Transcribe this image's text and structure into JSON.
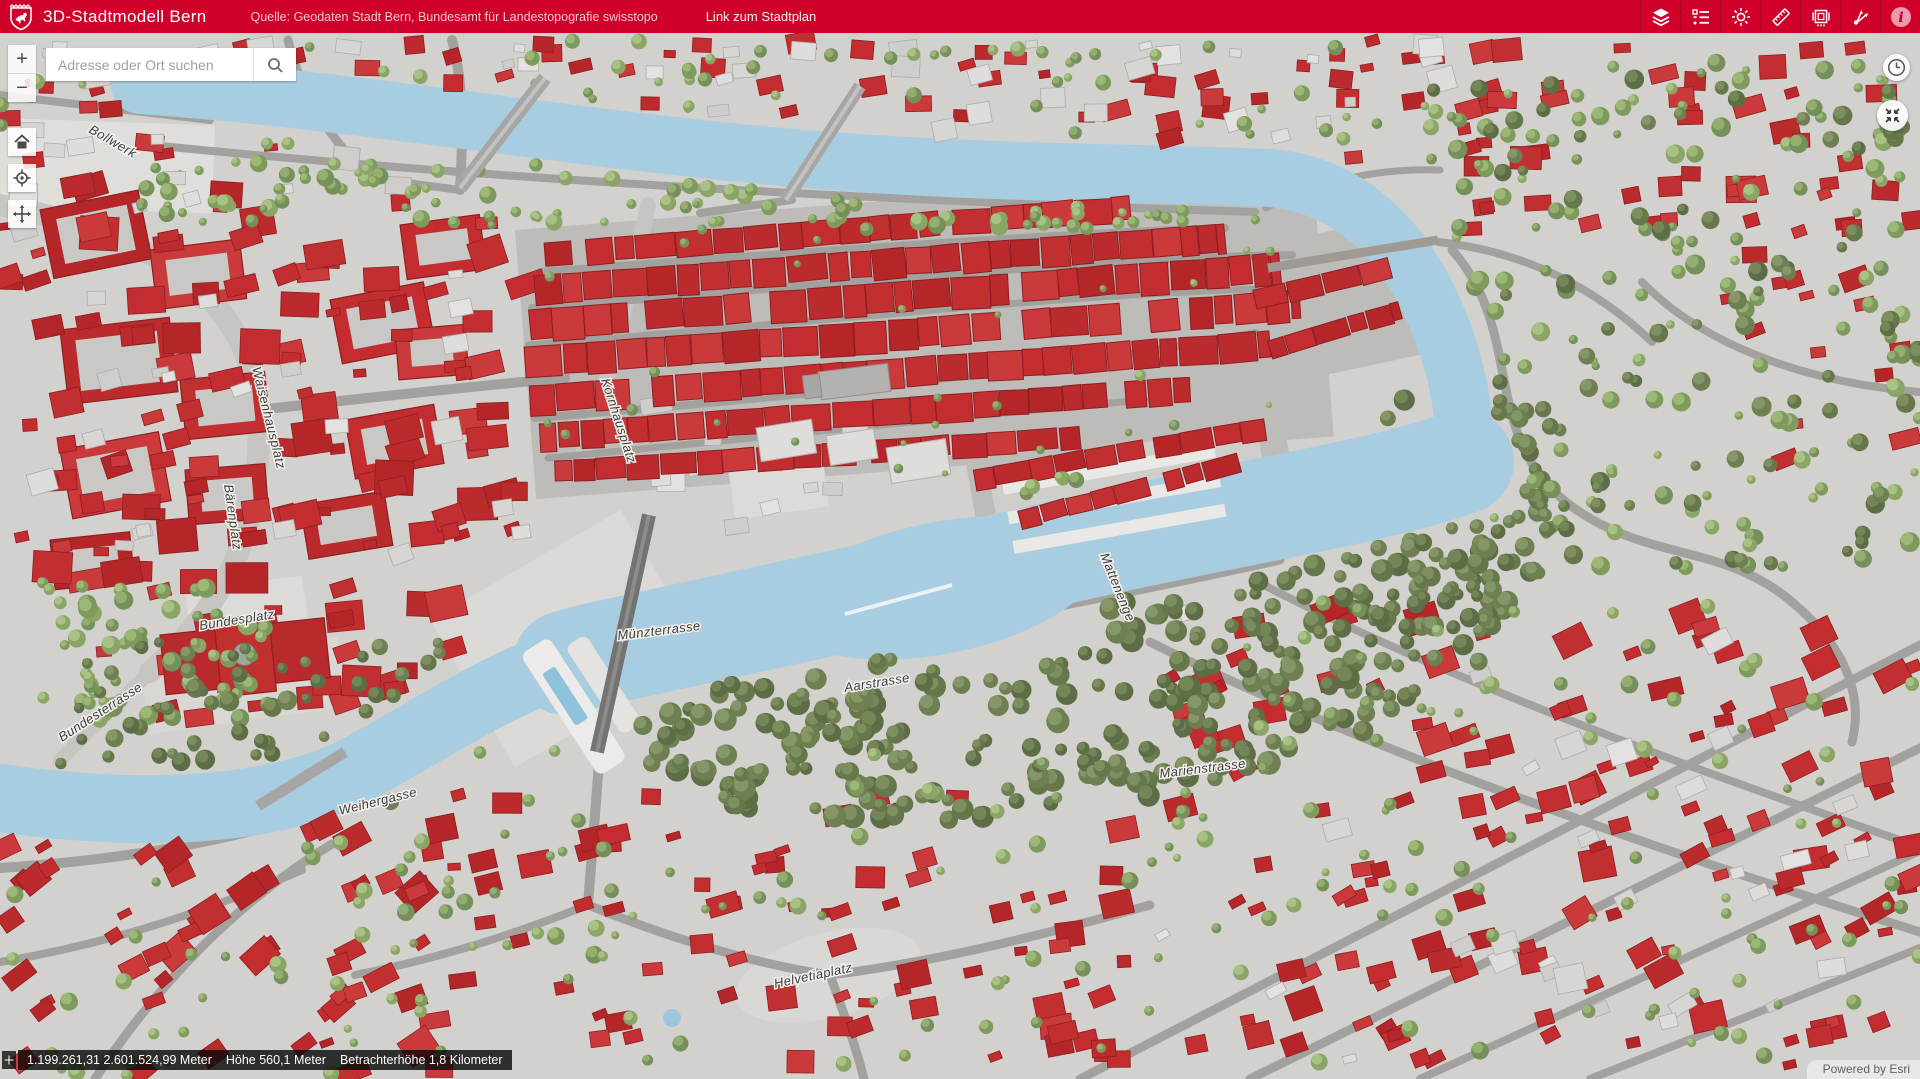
{
  "app": {
    "title": "3D-Stadtmodell Bern",
    "source_text": "Quelle: Geodaten Stadt Bern, Bundesamt für Landestopografie swisstopo",
    "stadtplan_link_label": "Link zum Stadtplan",
    "header_color": "#d0002b",
    "tools": [
      "layers",
      "legend",
      "daylight",
      "measure",
      "slides",
      "share",
      "info"
    ]
  },
  "search": {
    "placeholder": "Adresse oder Ort suchen"
  },
  "controls": {
    "zoom_in": "+",
    "zoom_out": "−"
  },
  "statusbar": {
    "coordinates": "1.199.261,31 2.601.524,99 Meter",
    "height_label": "Höhe 560,1 Meter",
    "viewer_height_label": "Betrachterhöhe 1,8 Kilometer"
  },
  "attribution": {
    "powered_by": "Powered by Esri"
  },
  "map": {
    "colors": {
      "river": "#a9cde0",
      "ground": "#d2d1ce",
      "road": "#a2a19e",
      "roof": "#c22f31",
      "roof_dark": "#8e1f22",
      "tree_light": "#9cb877",
      "tree_dark": "#7d8f5f"
    },
    "street_labels": [
      {
        "text": "Bollwerk",
        "x": 88,
        "y": 132,
        "rot": 30
      },
      {
        "text": "Waisenhausplatz",
        "x": 252,
        "y": 368,
        "rot": 76
      },
      {
        "text": "Kornhausplatz",
        "x": 601,
        "y": 380,
        "rot": 72
      },
      {
        "text": "Bärenplatz",
        "x": 224,
        "y": 485,
        "rot": 82
      },
      {
        "text": "Bundesplatz",
        "x": 200,
        "y": 630,
        "rot": -9
      },
      {
        "text": "Münzterrasse",
        "x": 618,
        "y": 640,
        "rot": -7
      },
      {
        "text": "Mattenenge",
        "x": 1100,
        "y": 555,
        "rot": 68
      },
      {
        "text": "Aarstrasse",
        "x": 845,
        "y": 692,
        "rot": -9
      },
      {
        "text": "Bundesterrasse",
        "x": 62,
        "y": 742,
        "rot": -33
      },
      {
        "text": "Weihergasse",
        "x": 340,
        "y": 815,
        "rot": -14
      },
      {
        "text": "Marienstrasse",
        "x": 1160,
        "y": 778,
        "rot": -7
      },
      {
        "text": "Helvetiaplatz",
        "x": 775,
        "y": 988,
        "rot": -12
      }
    ]
  }
}
